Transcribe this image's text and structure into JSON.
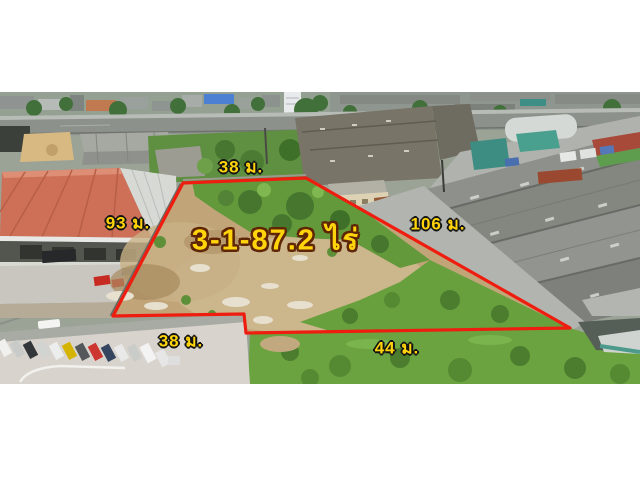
{
  "photo": {
    "kind": "aerial drone photo of vacant land plot among factories",
    "frame_color": "#ffffff"
  },
  "annotation": {
    "area_text": "3-1-87.2 ไร่",
    "labels": {
      "top": "38 ม.",
      "left": "93 ม.",
      "right": "106 ม.",
      "front_left": "38 ม.",
      "bottom": "44 ม."
    },
    "colors": {
      "boundary": "#ee1d0f",
      "label_fill": "#ffd40a",
      "label_outline": "#141414",
      "area_outline": "#5e2506"
    }
  }
}
